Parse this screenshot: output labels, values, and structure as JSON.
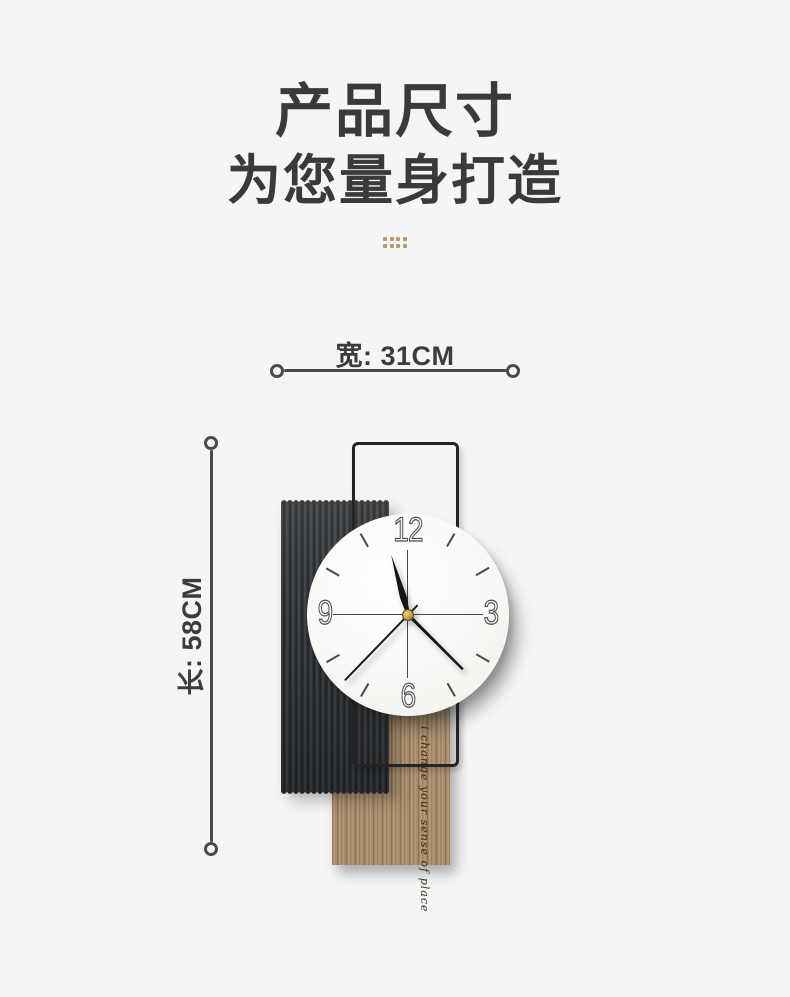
{
  "page": {
    "background_color": "#f5f5f5"
  },
  "header": {
    "title_line1": "产品尺寸",
    "title_line2": "为您量身打造",
    "text_color": "#3a3a3c",
    "divider_dots": {
      "rows": 2,
      "cols": 4,
      "color": "#b49a6e"
    }
  },
  "dimensions": {
    "width": {
      "label": "宽: 31CM",
      "value": "31CM"
    },
    "height": {
      "label": "长: 58CM",
      "value": "58CM"
    },
    "line_color": "#4a4a4d"
  },
  "product": {
    "wood_script": "i change your sense of place",
    "panel_colors": {
      "ribbed_panel": "#323539",
      "wood_panel": "#a78c6c",
      "metal_frame": "#242427",
      "clock_face": "#f8f8f6"
    },
    "clock": {
      "numerals": [
        "12",
        "3",
        "6",
        "9"
      ],
      "numeral_angles": [
        0,
        90,
        180,
        270
      ],
      "tick_angles": [
        30,
        60,
        120,
        150,
        210,
        240,
        300,
        330
      ],
      "hands": {
        "hour": {
          "angle": 344,
          "length": 63
        },
        "minute": {
          "angle": 135,
          "length": 77
        },
        "second": {
          "angle": 224,
          "length": 91,
          "tail": 14
        }
      },
      "center_cap_color": "#c49d42"
    }
  }
}
